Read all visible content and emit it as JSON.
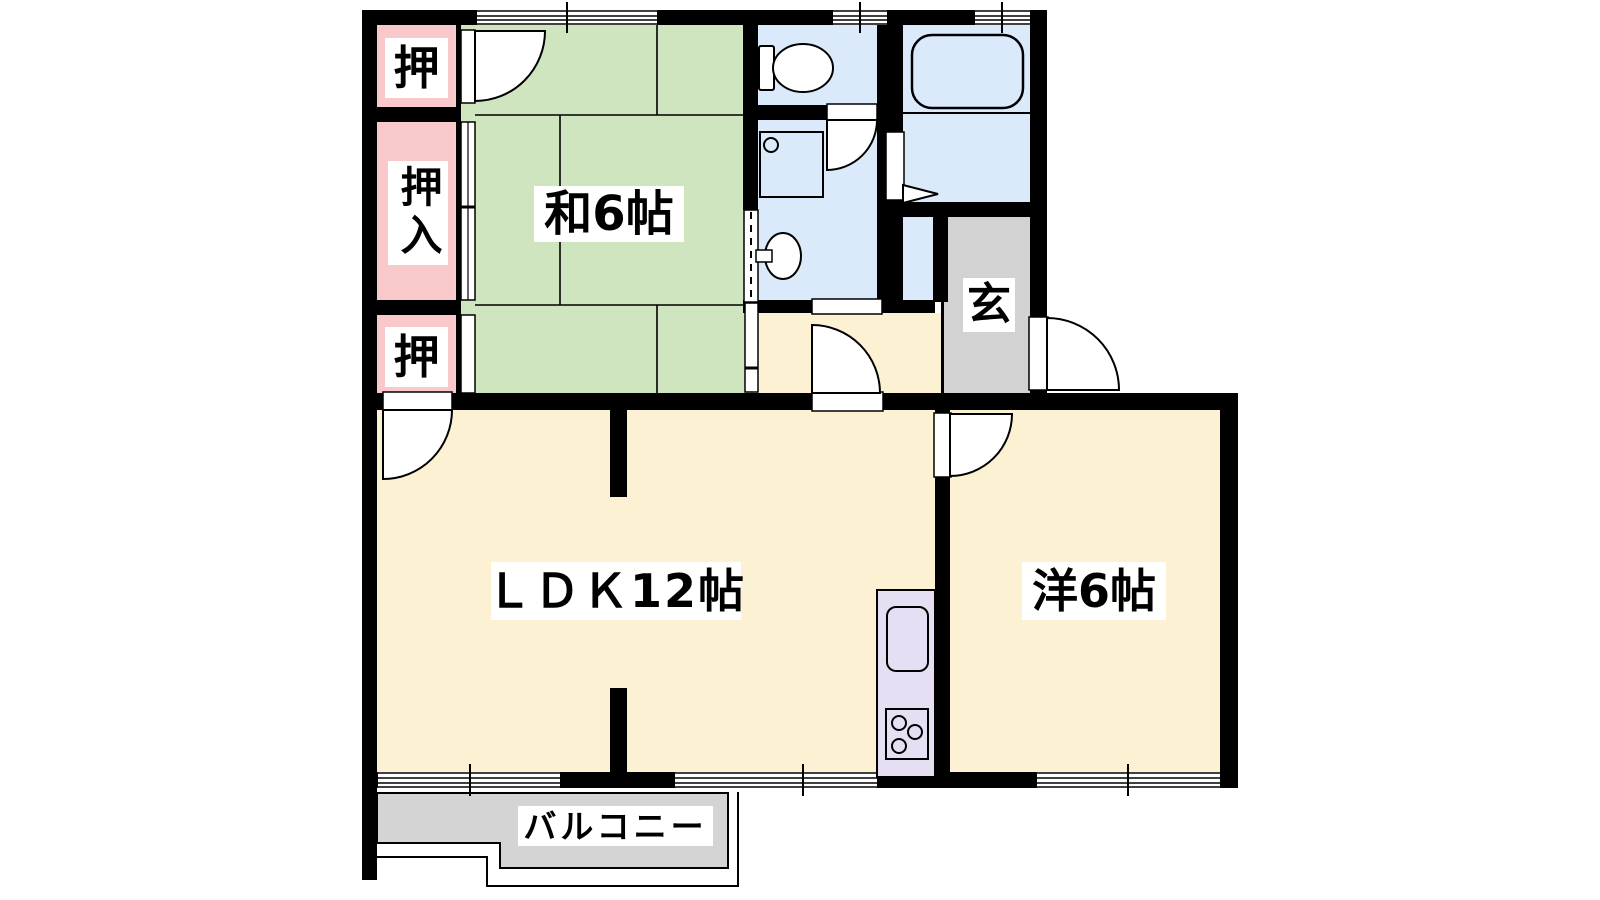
{
  "plan": {
    "type": "apartment-floor-plan",
    "labels": {
      "closet_top": "押",
      "closet_middle": "押入",
      "closet_bottom": "押",
      "tatami_room": "和6帖",
      "ldk": "ＬＤＫ12帖",
      "western_room": "洋6帖",
      "entrance": "玄",
      "balcony": "バルコニー"
    }
  },
  "colors": {
    "background": "#ffffff",
    "wall": "#000000",
    "tatami_floor": "#cfe5c0",
    "closet_floor": "#f9c8ca",
    "ldk_floor": "#fcf1d3",
    "western_floor": "#fcf1d3",
    "hall_floor": "#fcf1d3",
    "sanitary_floor": "#dbeafa",
    "genkan_floor": "#d2d2d2",
    "balcony_floor": "#d4d4d4",
    "kitchen_unit": "#e6def2",
    "fixture_fill": "#ffffff",
    "door_fill": "#ffffff",
    "opening_fill": "#ffffff",
    "line": "#000000",
    "label_bg": "#ffffff",
    "label_text": "#000000"
  }
}
